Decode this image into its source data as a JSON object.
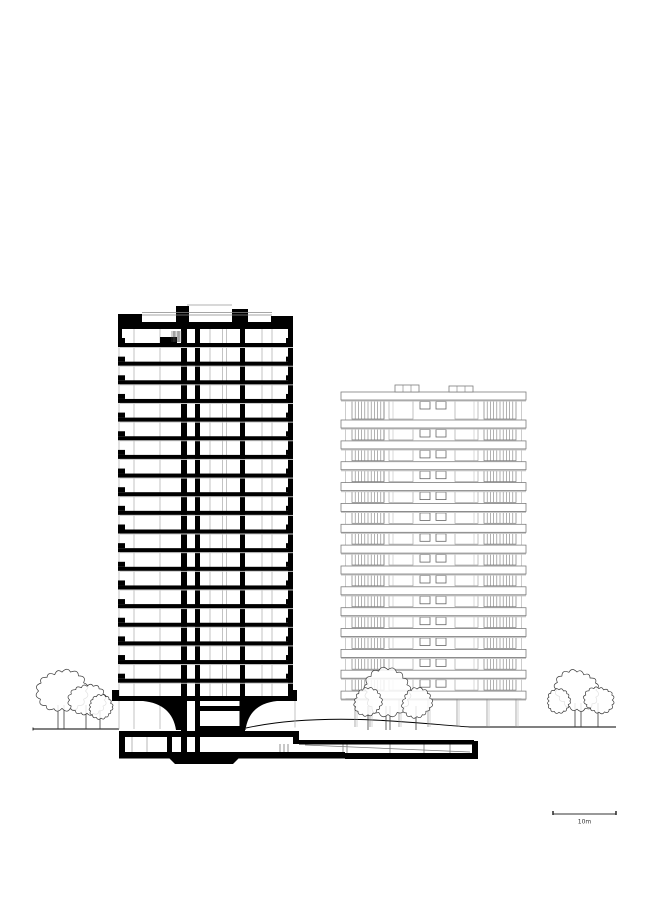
{
  "drawing": {
    "kind": "architectural-section-elevation",
    "canvas": {
      "width": 650,
      "height": 919,
      "background": "#ffffff"
    },
    "colors": {
      "ink": "#000000",
      "gray_line": "#7d7d7d",
      "faint_line": "#aaaaaa",
      "shadow": "#c9c9c9",
      "tree_line": "#3a3a3a"
    },
    "section_tower": {
      "x0": 118,
      "x1": 293,
      "typical_floors": 19,
      "first_slab_y": 343,
      "slab_spacing": 18.65,
      "slab_thickness": 4,
      "roof_y": 322,
      "roof_thickness": 7,
      "parapet_left": {
        "x": 118,
        "y": 314,
        "w": 24,
        "h": 15
      },
      "parapet_right": {
        "x": 271,
        "y": 316,
        "w": 22,
        "h": 13
      },
      "bulkhead_a": {
        "x": 176,
        "y": 306,
        "w": 13,
        "h": 23
      },
      "bulkhead_b": {
        "x": 232,
        "y": 309,
        "w": 16,
        "h": 20
      },
      "core_wall_a": {
        "x": 181,
        "w": 6,
        "y0": 306,
        "y1": 758
      },
      "core_wall_b": {
        "x": 195,
        "w": 5,
        "y0": 322,
        "y1": 758
      },
      "inner_wall": {
        "x": 240,
        "w": 5,
        "y0": 329,
        "y1": 733
      },
      "right_wall": {
        "x": 288,
        "w": 5,
        "y0": 329,
        "y1": 701
      },
      "glazing_xs": [
        119,
        134,
        160,
        210,
        222.5,
        226.5,
        262,
        272
      ],
      "transfer_slab": {
        "x": 112,
        "y": 696,
        "w": 185,
        "h": 5
      },
      "ground_floor_top": 701,
      "ground_floor_bottom": 729,
      "mezzanine_bars": [
        {
          "x": 200,
          "y": 706,
          "w": 40,
          "h": 5
        },
        {
          "x": 200,
          "y": 726,
          "w": 40,
          "h": 5
        }
      ]
    },
    "elevation_tower": {
      "x0": 341,
      "x1": 526,
      "band_height": 8,
      "band_ys": [
        392,
        420,
        440.9,
        461.7,
        482.6,
        503.4,
        524.3,
        545.1,
        566.0,
        586.8,
        607.7,
        628.5,
        649.4,
        670.2,
        691.1
      ],
      "rail_left": {
        "x0": 352,
        "x1": 384,
        "bar_step": 3.2
      },
      "rail_right": {
        "x0": 484,
        "x1": 516,
        "bar_step": 3.2
      },
      "frame_a": {
        "x0": 389,
        "x1": 413
      },
      "frame_b": {
        "x0": 455,
        "x1": 478
      },
      "windows": [
        {
          "x": 420,
          "w": 10
        },
        {
          "x": 436,
          "w": 10
        }
      ],
      "roof_boxes": [
        {
          "x": 395,
          "y": 385,
          "w": 24,
          "h": 7,
          "divs": [
            403,
            411
          ]
        },
        {
          "x": 449,
          "y": 386,
          "w": 24,
          "h": 6,
          "divs": [
            457,
            465
          ]
        }
      ],
      "ground_floor": {
        "top": 699,
        "bottom": 727,
        "column_xs": [
          355,
          370,
          399,
          428,
          457,
          487,
          516
        ]
      }
    },
    "ground": {
      "left_line": {
        "x0": 33,
        "x1": 119,
        "y": 729
      },
      "mound_path": "M246,728 C280,720.5 320,718.5 360,719.5 C400,720.5 445,725.5 470,727 L616,727"
    },
    "basement": {
      "ceiling": {
        "x": 119,
        "y": 731,
        "w": 180,
        "h": 6
      },
      "step": {
        "x": 293,
        "y": 737,
        "w": 6,
        "h": 7
      },
      "garage_ceiling": {
        "x": 299,
        "y": 740,
        "w": 175,
        "h": 4.5
      },
      "left_wall": {
        "x": 119,
        "y": 731,
        "w": 6,
        "h": 27
      },
      "bottom_slab": {
        "x": 119,
        "y": 752,
        "w": 226,
        "h": 6.5
      },
      "garage_floor": {
        "x": 345,
        "y": 753,
        "w": 133,
        "h": 6
      },
      "end_wall": {
        "x": 472,
        "y": 741,
        "w": 6,
        "h": 18
      },
      "pile_cap": [
        [
          168,
          757
        ],
        [
          240,
          757
        ],
        [
          233,
          764
        ],
        [
          175,
          764
        ]
      ],
      "inner_wall": {
        "x": 167,
        "y": 737,
        "w": 5,
        "h": 15
      },
      "gray_columns": [
        132,
        147
      ],
      "garage_columns": [
        280,
        284,
        288,
        343,
        347,
        390,
        424,
        450
      ],
      "ramp": {
        "x0": 305,
        "y0": 745,
        "x1": 470,
        "y1": 752
      }
    },
    "trees": {
      "groups": [
        {
          "name": "left",
          "ground_y": 729,
          "canopies": [
            {
              "cx": 62,
              "cy": 691,
              "r": 23
            },
            {
              "cx": 87,
              "cy": 700,
              "r": 17
            },
            {
              "cx": 101,
              "cy": 707,
              "r": 12
            }
          ],
          "trunk_xs": [
            58,
            64,
            86,
            100
          ]
        },
        {
          "name": "middle",
          "ground_y": 730,
          "canopies": [
            {
              "cx": 388,
              "cy": 692,
              "r": 24
            },
            {
              "cx": 368,
              "cy": 702,
              "r": 14
            },
            {
              "cx": 417,
              "cy": 703,
              "r": 15
            }
          ],
          "trunk_xs": [
            386,
            390,
            368,
            416
          ]
        },
        {
          "name": "right",
          "ground_y": 727,
          "canopies": [
            {
              "cx": 577,
              "cy": 690,
              "r": 21
            },
            {
              "cx": 559,
              "cy": 701,
              "r": 12
            },
            {
              "cx": 599,
              "cy": 700,
              "r": 14
            }
          ],
          "trunk_xs": [
            575,
            581,
            598
          ]
        }
      ]
    },
    "scale_bar": {
      "x0": 553,
      "x1": 616,
      "y": 814,
      "tick_h": 4,
      "label": "10m"
    }
  }
}
